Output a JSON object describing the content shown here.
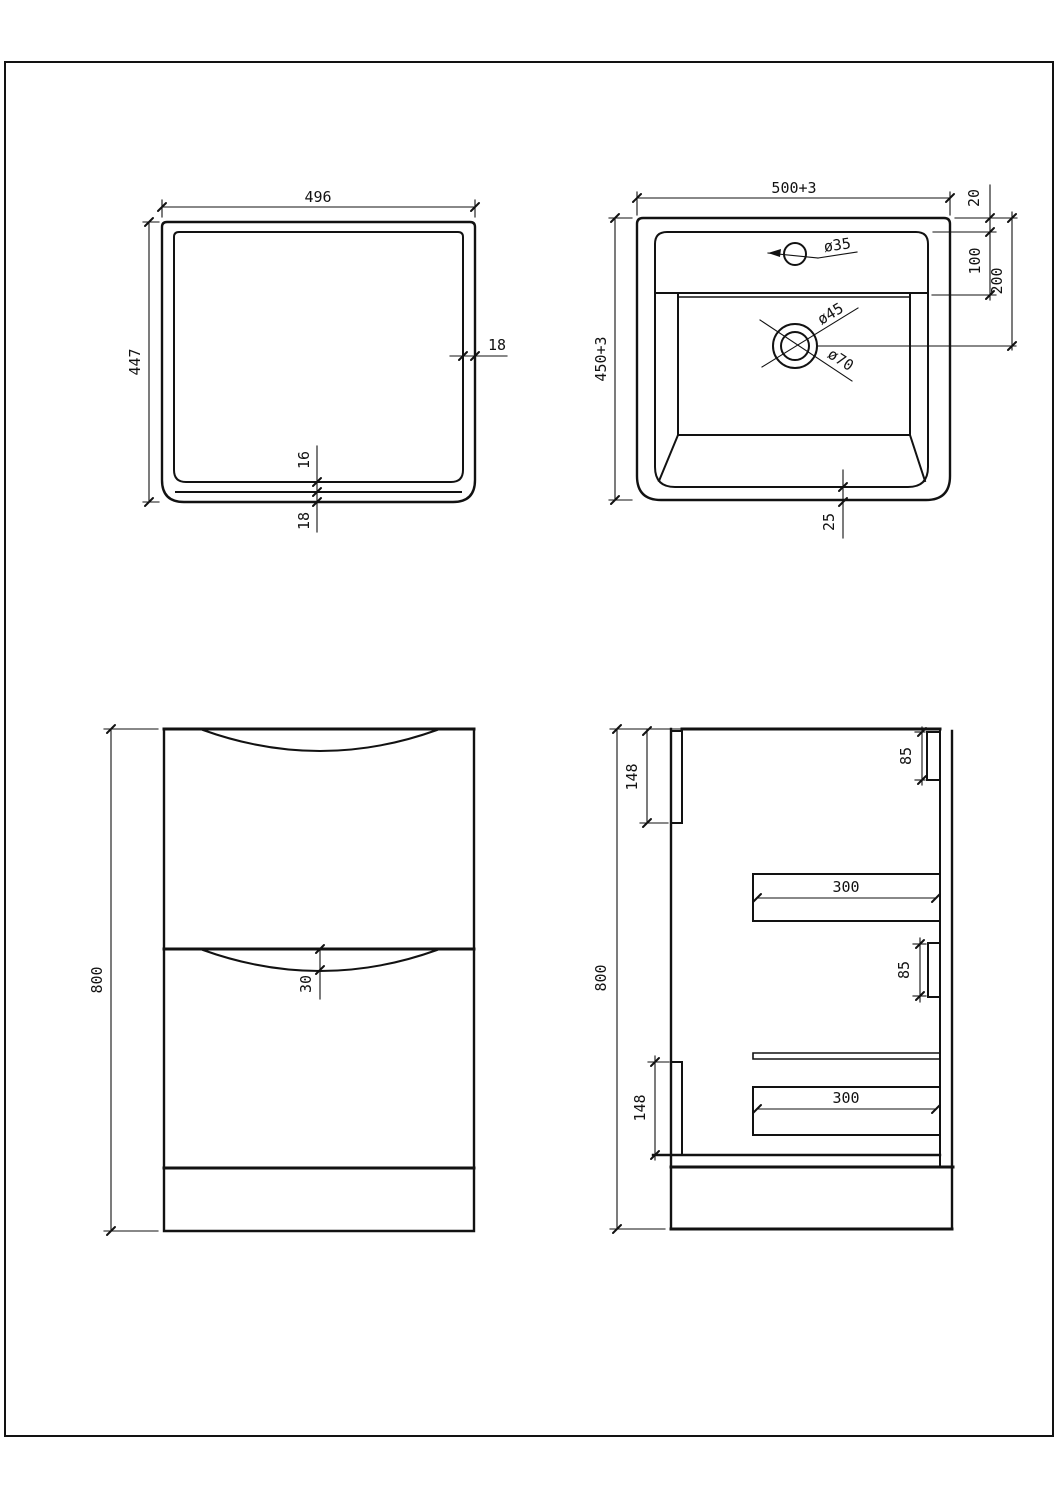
{
  "page": {
    "background": "#ffffff",
    "line_color": "#121212",
    "drawing_type": "vanity-unit-technical-drawing"
  },
  "views": {
    "cabinet_top": {
      "label": "cabinet-top-view",
      "width": "496",
      "height": "447",
      "wall_thickness": "18",
      "bottom_inner_thickness": "16",
      "bottom_outer_thickness": "18"
    },
    "basin_top": {
      "label": "basin-top-view",
      "width": "500+3",
      "depth": "450+3",
      "rim_offset": "20",
      "deck_depth": "100",
      "drain_center_offset": "200",
      "tap_hole_diameter": "ø35",
      "drain_diameter": "ø45",
      "drain_flange_diameter": "ø70",
      "base_clearance": "25"
    },
    "front": {
      "label": "front-view",
      "height": "800",
      "handle_recess_depth": "30"
    },
    "side": {
      "label": "side-section-view",
      "height": "800",
      "top_back_rail_height": "148",
      "top_front_rail_height": "85",
      "upper_drawer_length": "300",
      "mid_front_rail_height": "85",
      "lower_drawer_length": "300",
      "bottom_back_rail_height": "148"
    }
  }
}
